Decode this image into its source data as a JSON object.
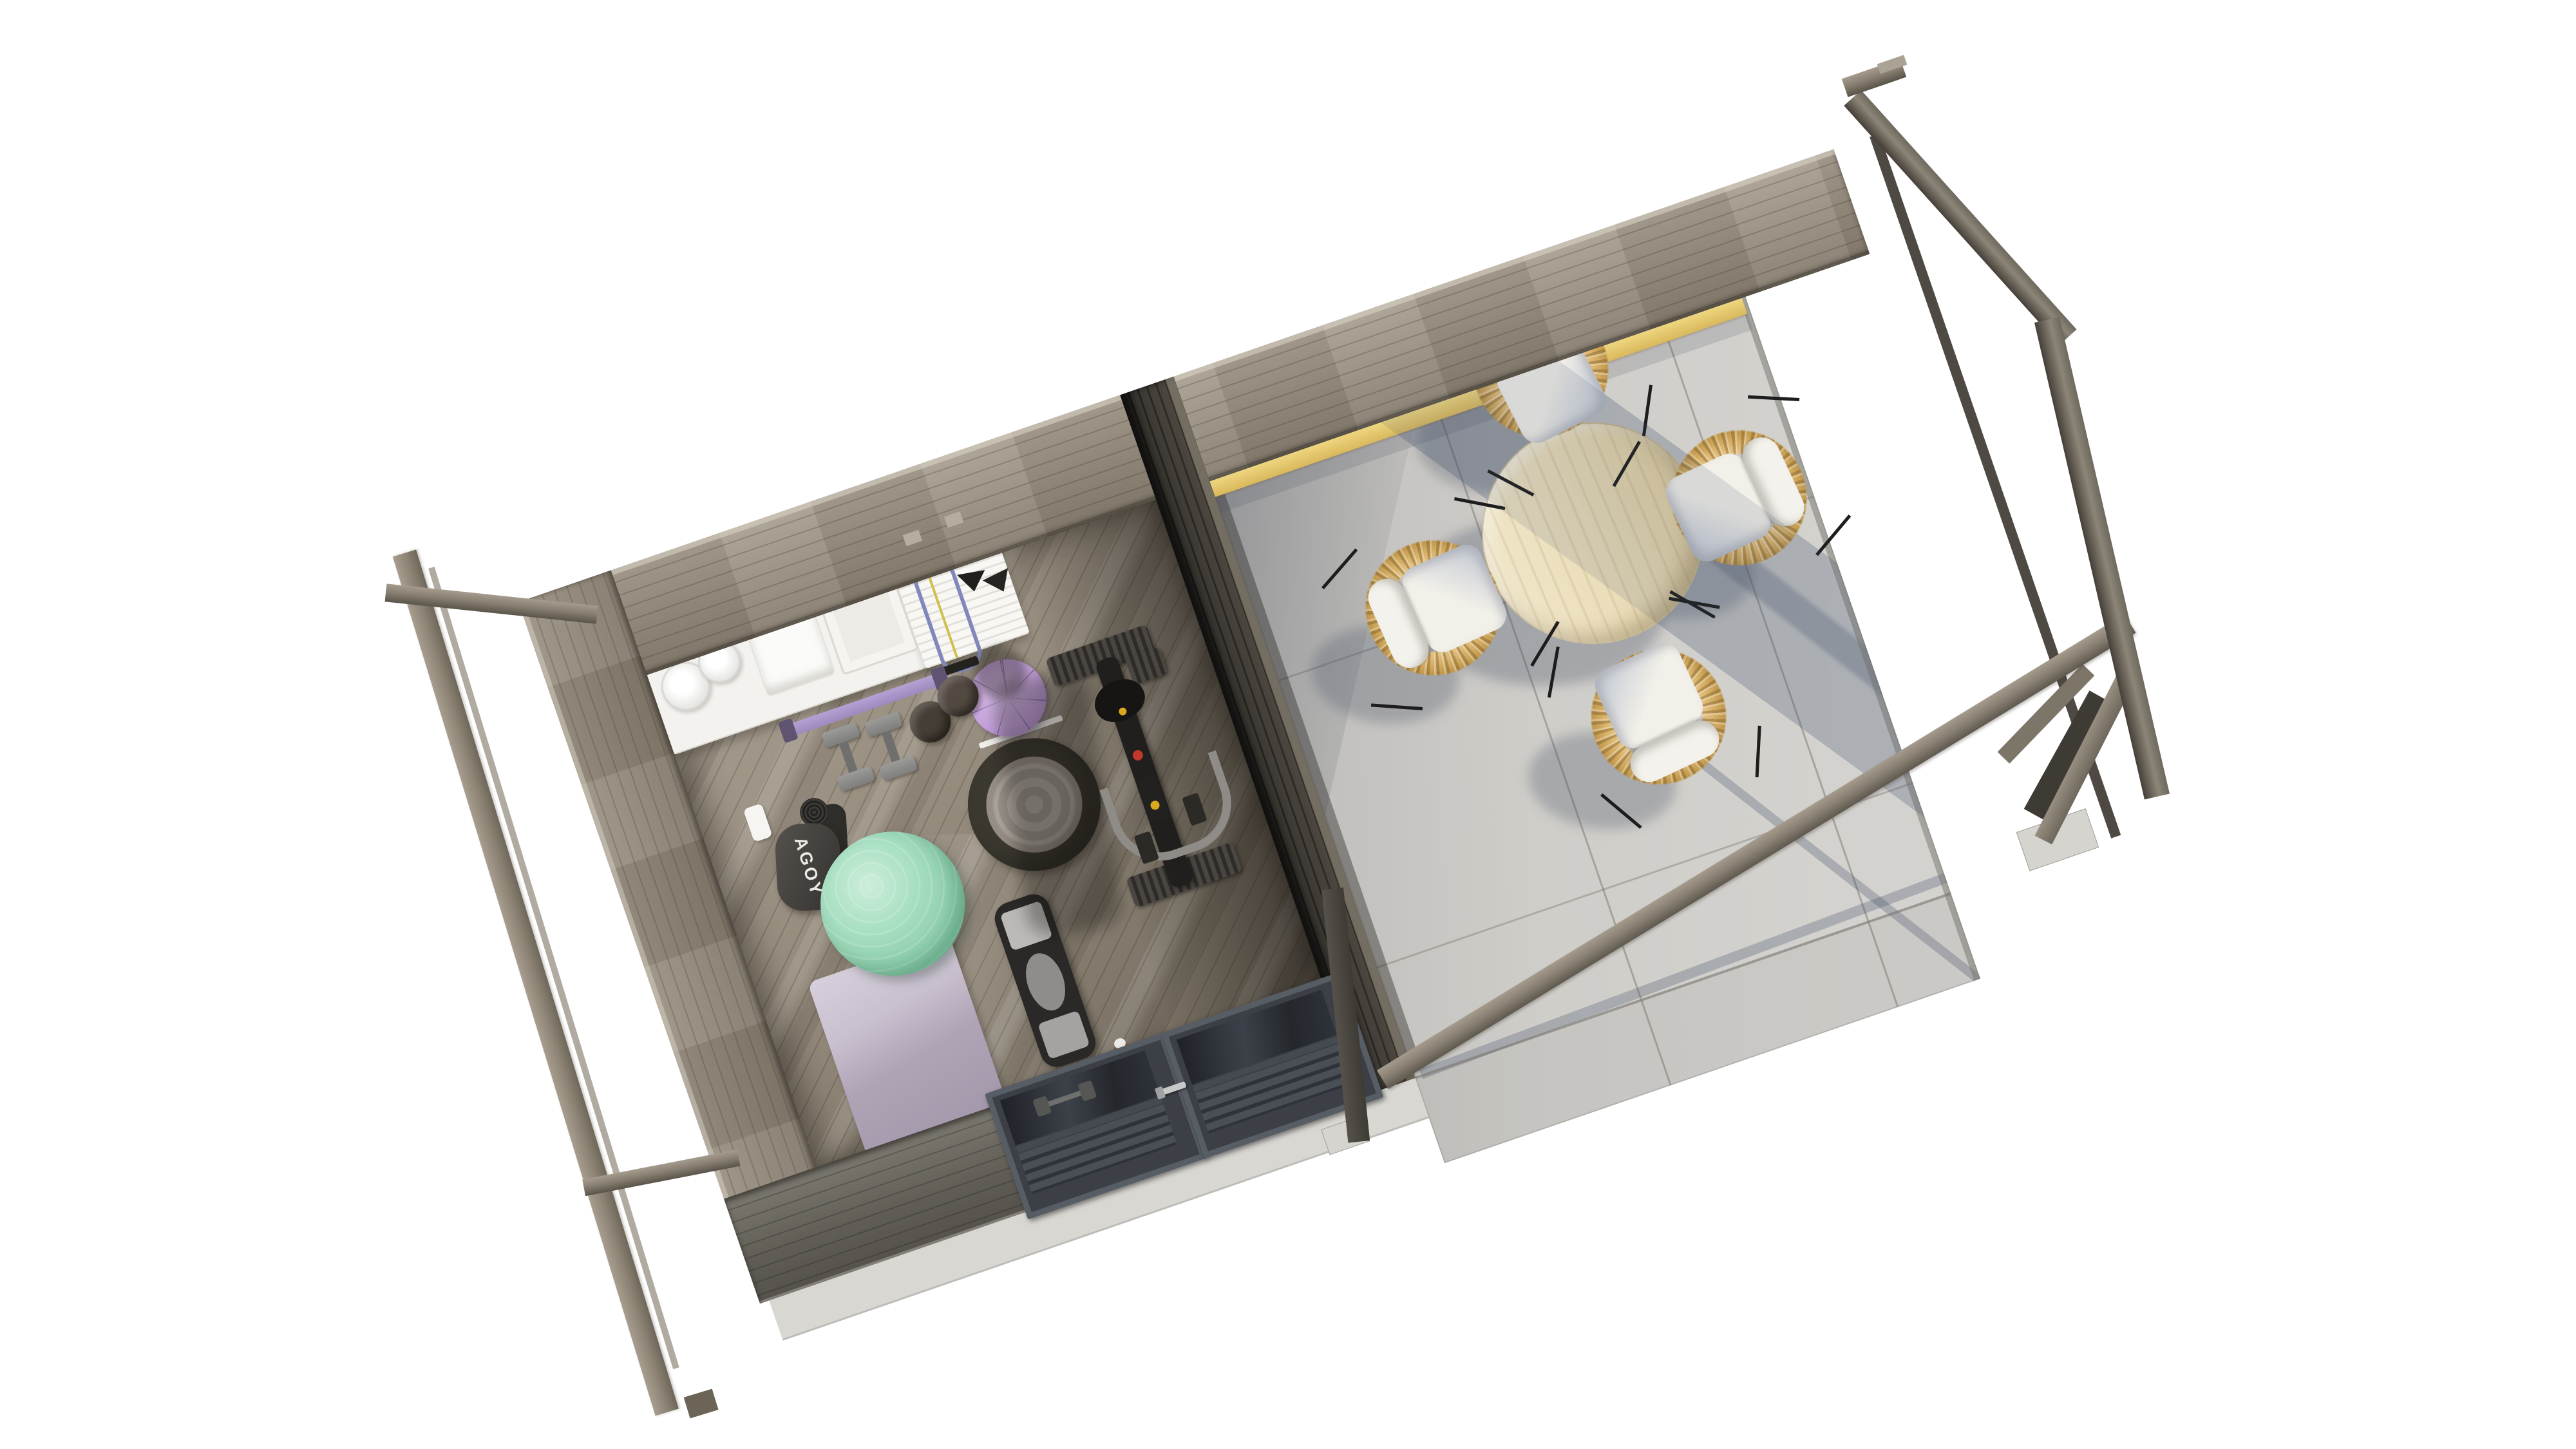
{
  "scene": {
    "type": "3d-architectural-render",
    "view": "top-down-aerial",
    "subject": "Weathered-wood garden cabin with a home gym room on the left and an open pergola terrace with dining set on the right",
    "background": "#ffffff"
  },
  "labels": {
    "mat_bag_brand": "AGOY"
  },
  "palette": {
    "wall_wood": "#968d7f",
    "dark_partition": "#37332d",
    "gym_floor_wood": "#8f8678",
    "terrace_concrete": "#cac8c3",
    "accent_yellow_plate": "#e3c46e",
    "table_top": "#e9dcb8",
    "chair_rattan": "#d9b26a",
    "chair_cushion": "#f2f0e9",
    "exercise_ball_green": "#93d1b0",
    "pilates_ball_purple": "#c7a4de",
    "yoga_mat_lavender": "#b4a8ba",
    "door_frame": "#575d64",
    "shadow_blue": "#485a6e"
  },
  "gym": {
    "items": [
      "wall shelf with rolled towels",
      "folded towels",
      "storage box",
      "slat hanging panel",
      "resistance band",
      "gymnastic hangers",
      "purple pilates ball",
      "barbell pad bar",
      "two dumbbells",
      "two kettlebells",
      "white bottle",
      "black yoga mat bag",
      "rolled dark mat",
      "green exercise ball",
      "bosu balance trainer",
      "lavender yoga mat",
      "balance board",
      "massage oil bottle",
      "wooden block",
      "black spin bike",
      "double glass door with slats"
    ]
  },
  "terrace": {
    "items": [
      "round wooden dining table",
      "four rattan chairs with white cushions",
      "concrete paver floor",
      "pergola perimeter beams",
      "gable end beams with corner braces",
      "yellow sunlit wall plate"
    ]
  }
}
